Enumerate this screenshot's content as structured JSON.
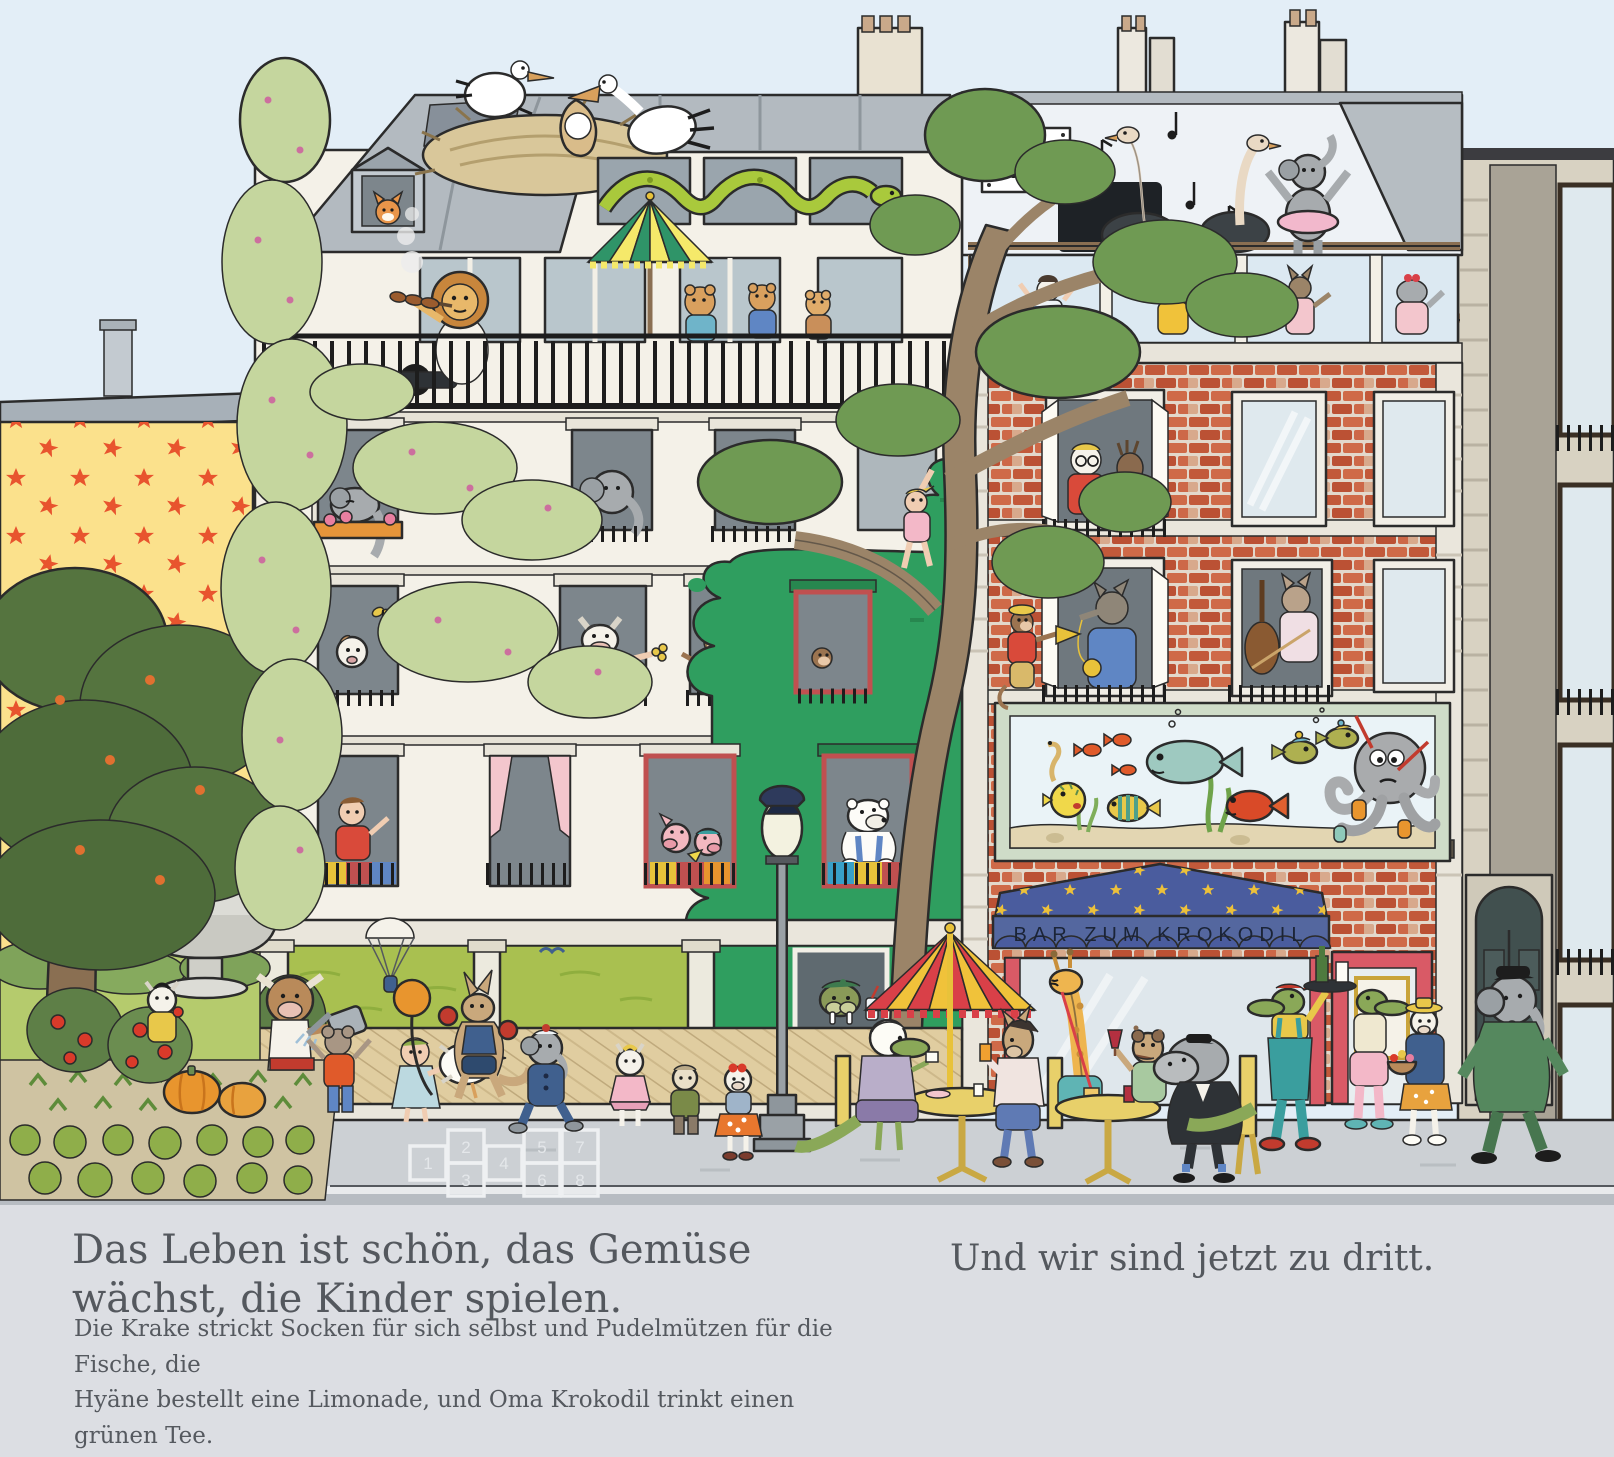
{
  "signs": {
    "dance_school_line1": "TANZ-",
    "dance_school_line2": "KURSE",
    "bar_awning": "BAR ZUM KROKODIL"
  },
  "captions": {
    "headline_line1": "Das Leben ist schön, das Gemüse",
    "headline_line2": "wächst, die Kinder spielen.",
    "body_line1": "Die Krake strickt Socken für sich selbst und Pudelmützen für die Fische, die",
    "body_line2": "Hyäne bestellt eine Limonade, und Oma Krokodil trinkt einen grünen Tee.",
    "body_line3": "Überall ist etwas los.",
    "right_caption": "Und wir sind jetzt zu dritt."
  },
  "hopscotch": {
    "numbers": [
      "1",
      "2",
      "3",
      "4",
      "5",
      "6",
      "7",
      "8"
    ]
  },
  "palette": {
    "sky": "#e3eef7",
    "caption_band": "#dcdee3",
    "caption_text": "#54585e",
    "center_building_cream": "#f4f1e8",
    "roof_gray": "#b3bac0",
    "paint_splash_green": "#2f9e5f",
    "brick_red": "#c2593a",
    "brick_mortar": "#e3d8cb",
    "star_wall_yellow": "#fbe18c",
    "star_orange": "#e8542e",
    "awning_blue": "#4a5c9e",
    "awning_star_yellow": "#edc13a",
    "bar_front_red": "#d95a66",
    "lawn_green": "#b5cb6d",
    "ground_floor_green": "#a9c050",
    "tree_dark_green": "#55743f",
    "ivy_light_green": "#c5d69e",
    "cafe_umbrella_red": "#d94048",
    "cafe_umbrella_yellow": "#f0c23a",
    "terrace_umbrella_green": "#2f9468",
    "terrace_umbrella_yellow": "#f5e96a",
    "sidewalk_gray": "#ccd0d4",
    "road_gray": "#b7bcc2",
    "aquarium_water": "#eaf3f7",
    "wood_deck": "#e0cda0"
  }
}
